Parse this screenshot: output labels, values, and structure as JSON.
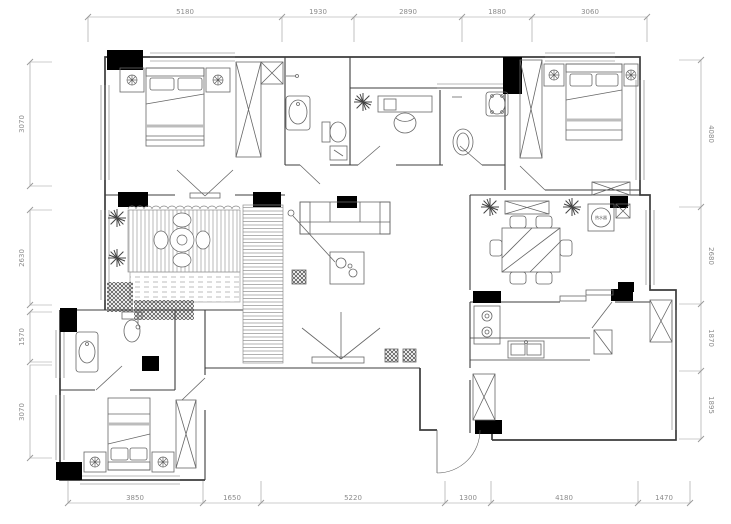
{
  "dims": {
    "top": [
      "5180",
      "1930",
      "2890",
      "1880",
      "3060"
    ],
    "bottom": [
      "3850",
      "1650",
      "5220",
      "1300",
      "4180",
      "1470"
    ],
    "left": [
      "3070",
      "2630",
      "1570",
      "3070"
    ],
    "right": [
      "4080",
      "2680",
      "1870",
      "1895"
    ]
  },
  "labels": {
    "water_heater": "热水器"
  },
  "colors": {
    "background": "#ffffff",
    "wall": "#3c3c3c",
    "furniture": "#666666",
    "dimension": "#8c8c8c",
    "column": "#000000",
    "bed_accent": "#bcbcbc"
  }
}
